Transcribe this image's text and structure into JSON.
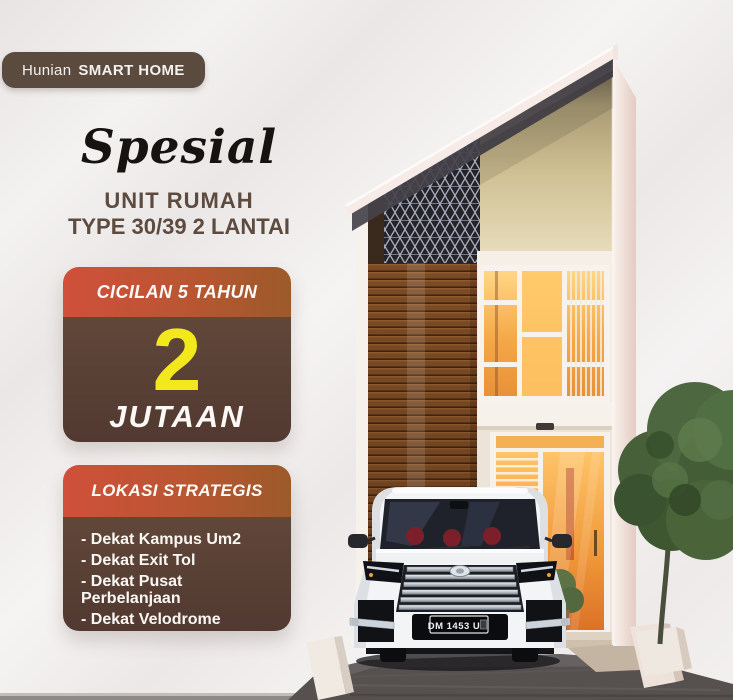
{
  "page": {
    "background": "#f2f0ef",
    "accent_brown": "#5a4237",
    "header_gradient_left": "#d0503a",
    "header_gradient_right": "#9c5a2a",
    "accent_yellow": "#f3e81c",
    "title_brown": "#5e4b3f"
  },
  "badge": {
    "prefix": "Hunian",
    "bold": "SMART HOME"
  },
  "headline": {
    "script": "Spesial",
    "line1": "UNIT RUMAH",
    "line2": "TYPE 30/39 2 LANTAI"
  },
  "installment_card": {
    "header": "CICILAN 5 TAHUN",
    "amount": "2",
    "unit": "JUTAAN"
  },
  "location_card": {
    "header": "LOKASI STRATEGIS",
    "items": [
      "- Dekat Kampus Um2",
      "- Dekat Exit Tol",
      "- Dekat Pusat Perbelanjaan",
      "- Dekat Velodrome"
    ]
  },
  "scene": {
    "license_plate": "DM 1453 U",
    "house_description": "two-story-smart-home-render",
    "vehicle": "white-mpv-front-view",
    "tree": "green-tree-right-side"
  }
}
